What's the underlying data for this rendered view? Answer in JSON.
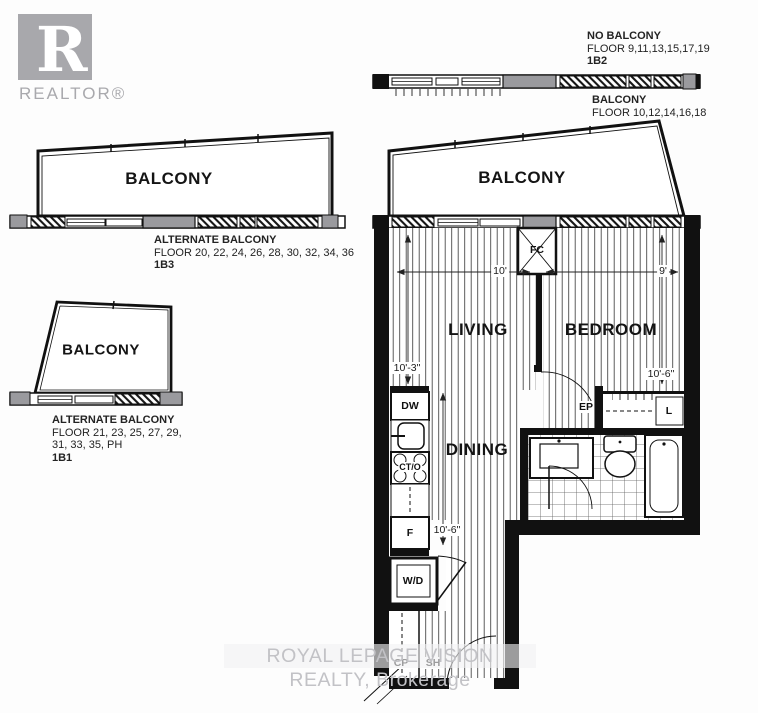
{
  "colors": {
    "wall": "#111111",
    "gray_fill": "#9a9a9e",
    "floor_line": "#4a4a4a",
    "logo_gray": "#a8a8ac",
    "watermark_gray": "#c2c2c6"
  },
  "realtor_logo": {
    "letter": "R",
    "label": "REALTOR®"
  },
  "variant_1b2": {
    "title": "NO BALCONY",
    "floors": "FLOOR 9,11,13,15,17,19",
    "code": "1B2"
  },
  "variant_balcony_note": {
    "title": "BALCONY",
    "floors": "FLOOR 10,12,14,16,18"
  },
  "variant_1b3": {
    "balcony_label": "BALCONY",
    "title": "ALTERNATE BALCONY",
    "floors": "FLOOR 20, 22, 24, 26, 28, 30, 32, 34, 36",
    "code": "1B3"
  },
  "variant_1b1": {
    "balcony_label": "BALCONY",
    "title": "ALTERNATE BALCONY",
    "floors_line1": "FLOOR 21, 23, 25, 27, 29,",
    "floors_line2": "31, 33, 35, PH",
    "code": "1B1"
  },
  "unit": {
    "balcony_label": "BALCONY",
    "rooms": {
      "living": "LIVING",
      "bedroom": "BEDROOM",
      "dining": "DINING"
    },
    "fixtures": {
      "fan_coil": "FC",
      "dishwasher": "DW",
      "cooktop_oven": "CT/O",
      "fridge": "F",
      "washer_dryer": "W/D",
      "coat_closet": "CP",
      "shelf": "SH",
      "electrical_panel": "EP",
      "linen": "L"
    },
    "dimensions": {
      "living_width": "10'",
      "bedroom_width": "9'",
      "living_depth": "10'-3\"",
      "dining_depth": "10'-6\"",
      "bedroom_depth": "10'-6\""
    }
  },
  "watermark": "ROYAL LEPAGE VISION REALTY, Brokerage"
}
